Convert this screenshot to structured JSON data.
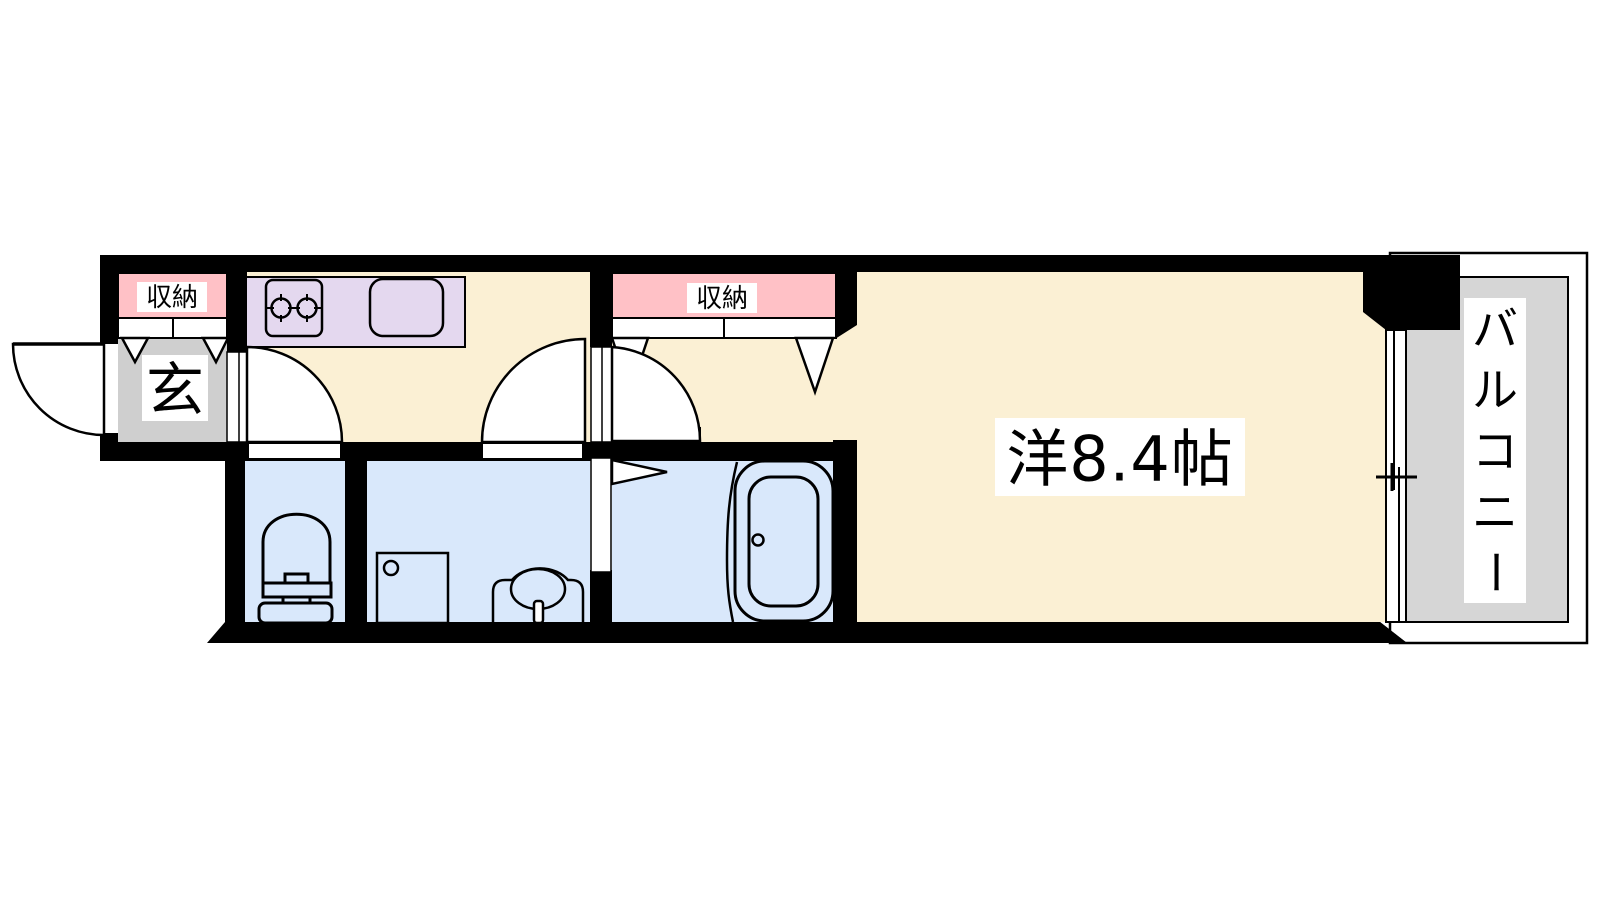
{
  "floor_plan": {
    "type": "japanese-apartment-floorplan",
    "labels": {
      "entrance_storage": "収納",
      "hall_storage": "収納",
      "entrance": "玄",
      "main_room": "洋8.4帖",
      "balcony": "バルコニー",
      "balcony_chars": [
        "バ",
        "ル",
        "コ",
        "ニ",
        "ー"
      ]
    },
    "colors": {
      "wall": "#000000",
      "room_cream": "#FBF0D4",
      "kitchen_counter_purple": "#E4D8EF",
      "storage_pink": "#FFC1C6",
      "entrance_gray": "#CFCFCF",
      "balcony_gray": "#D6D6D6",
      "wet_room_blue": "#D9E8FB",
      "line": "#000000",
      "label_background": "#FFFFFF"
    }
  }
}
